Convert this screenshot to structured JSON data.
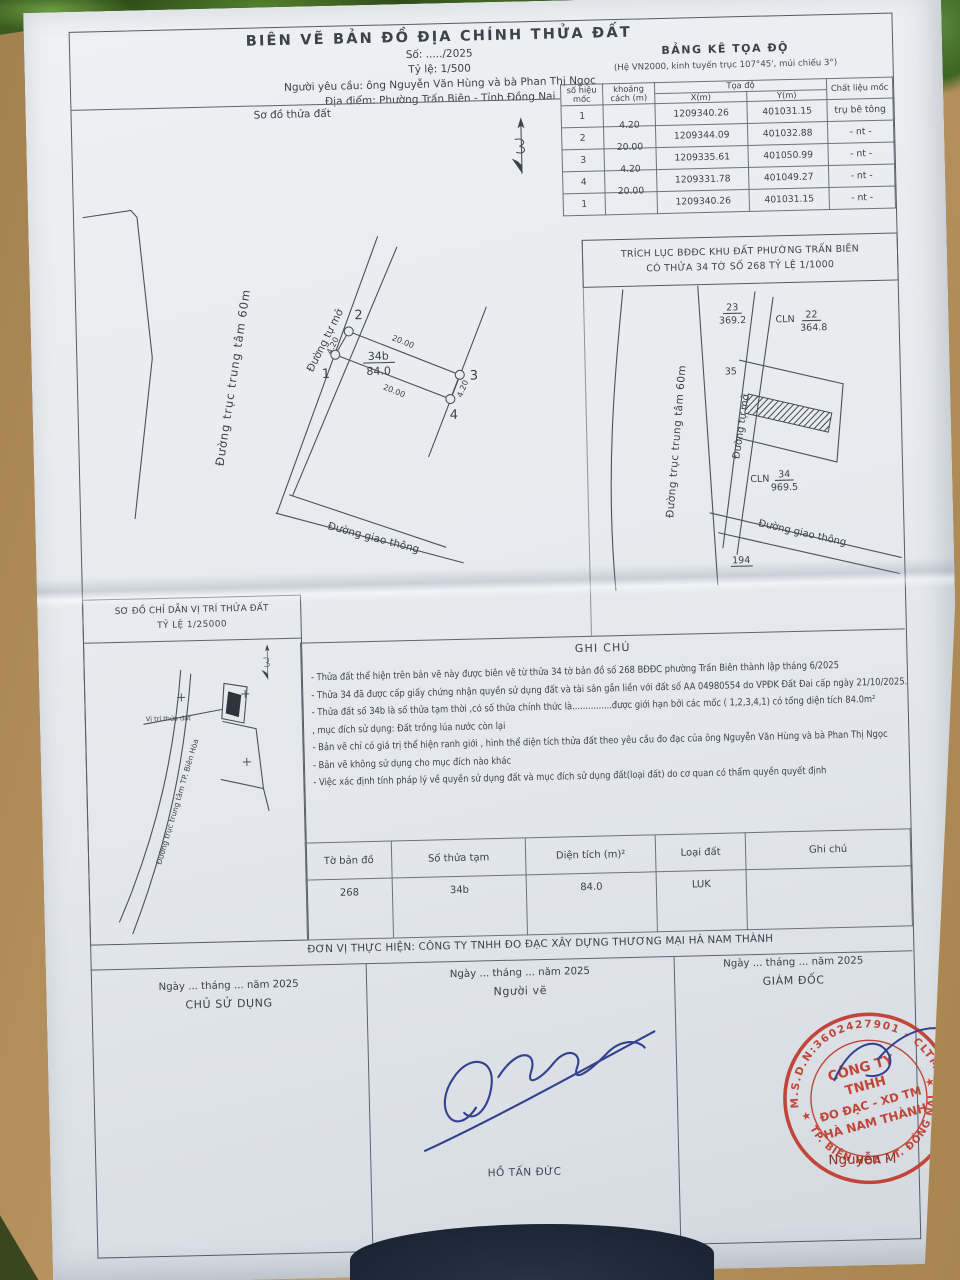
{
  "background": {
    "floor": "#b6925f",
    "foliage": "#3f6323",
    "dark_object": "#1f2838"
  },
  "doc": {
    "header": {
      "title": "BIÊN VẼ BẢN ĐỒ ĐỊA CHÍNH THỬA ĐẤT",
      "so": "Số: ...../2025",
      "scale": "Tỷ lệ: 1/500",
      "requester": "Người yêu cầu: ông Nguyễn Văn Hùng và bà Phan Thị Ngọc",
      "location": "Địa điểm: Phường Trấn Biên - Tỉnh Đồng Nai"
    },
    "coord_table": {
      "title": "BẢNG KÊ TỌA ĐỘ",
      "subtitle": "(Hệ VN2000, kinh tuyến trục 107°45', múi chiếu 3°)",
      "col_point": "số hiệu mốc",
      "col_distance": "khoảng cách (m)",
      "col_coords": "Tọa độ",
      "col_x": "X(m)",
      "col_y": "Y(m)",
      "col_material": "Chất liệu mốc",
      "rows": [
        {
          "point": "1",
          "distance": "4.20",
          "x": "1209340.26",
          "y": "401031.15",
          "material": "trụ bê tông"
        },
        {
          "point": "2",
          "distance": "20.00",
          "x": "1209344.09",
          "y": "401032.88",
          "material": "- nt -"
        },
        {
          "point": "3",
          "distance": "4.20",
          "x": "1209335.61",
          "y": "401050.99",
          "material": "- nt -"
        },
        {
          "point": "4",
          "distance": "20.00",
          "x": "1209331.78",
          "y": "401049.27",
          "material": "- nt -"
        },
        {
          "point": "1",
          "distance": "",
          "x": "1209340.26",
          "y": "401031.15",
          "material": "- nt -"
        }
      ]
    },
    "plot_sketch": {
      "label": "Sơ đồ thửa đất",
      "road_axis": "Đường trục trung tâm 60m",
      "road_open": "Đường tự mở",
      "road_traffic": "Đường giao thông",
      "parcel_id": "34b",
      "parcel_area": "84.0",
      "dim_left": "4.20",
      "dim_top": "20.00",
      "dim_bottom": "20.00",
      "dim_right": "4.20",
      "points": [
        "1",
        "2",
        "3",
        "4"
      ]
    },
    "extract": {
      "title1": "TRÍCH LỤC BĐĐC KHU ĐẤT PHƯỜNG TRẤN BIÊN",
      "title2": "CÓ THỬA 34 TỜ SỐ 268 TỶ LỆ 1/1000",
      "road_axis": "Đường trục trung tâm 60m",
      "road_open": "Đường tự mở",
      "road_traffic": "Đường giao thông",
      "p23": "23",
      "p23_area": "369.2",
      "p22_type": "CLN",
      "p22": "22",
      "p22_area": "364.8",
      "p34_type": "CLN",
      "p34": "34",
      "p34_area": "969.5",
      "n35": "35",
      "n194": "194"
    },
    "location": {
      "title": "SƠ ĐỒ CHỈ DẪN VỊ TRÍ THỬA ĐẤT",
      "scale": "TỶ LỆ 1/25000",
      "marker": "Vị trí thửa đất",
      "road": "Đường trục trung tâm TP. Biên Hòa"
    },
    "notes": {
      "title": "GHI CHÚ",
      "items": [
        "- Thửa đất thể hiện trên bản vẽ này được biên vẽ từ thửa 34 tờ bản đồ số 268 BĐĐC phường Trấn Biên thành lập tháng 6/2025",
        "- Thửa 34 đã được cấp giấy chứng nhận quyền sử dụng đất và tài sản gắn liền với đất số AA 04980554 do VPĐK Đất Đai cấp ngày 21/10/2025.",
        "- Thửa đất số 34b là số thửa tạm thời ,có số thửa chính thức là...............được giới hạn bởi các mốc ( 1,2,3,4,1) có tổng diện tích 84.0m²",
        ", mục đích sử dụng: Đất trồng lúa nước còn lại",
        "- Bản vẽ chỉ có giá trị thể hiện ranh giới , hình thể diện tích thửa đất theo yêu cầu đo đạc của ông Nguyễn Văn Hùng và bà Phan Thị Ngọc",
        "- Bản vẽ không sử dụng cho mục đích nào khác",
        "- Việc xác định tính pháp lý về quyền sử dụng đất và mục đích sử dụng đất(loại đất) do cơ quan có thẩm quyền quyết định"
      ]
    },
    "summary": {
      "headers": [
        "Tờ bản đồ",
        "Số thửa tạm",
        "Diện tích (m)²",
        "Loại đất",
        "Ghi chú"
      ],
      "values": [
        "268",
        "34b",
        "84.0",
        "LUK",
        ""
      ]
    },
    "executor": "ĐƠN VỊ THỰC HIỆN: CÔNG TY TNHH ĐO ĐẠC XÂY DỰNG THƯƠNG MẠI HÀ NAM THÀNH",
    "sign": {
      "date": "Ngày ... tháng ... năm 2025",
      "role1": "CHỦ SỬ DỤNG",
      "role2": "Người vẽ",
      "name2": "HỒ TẤN ĐỨC",
      "role3": "GIÁM ĐỐC",
      "name3": "Nguyễn M"
    },
    "stamp": {
      "ring_top": "M.S.D.N:3602427901 - CLTM",
      "ring_bottom": "TP. BIÊN HÒA - T. ĐỒNG NAI",
      "l1": "CÔNG TY",
      "l2": "TNHH",
      "l3": "ĐO ĐẠC - XD TM",
      "l4": "HÀ NAM THÀNH",
      "star": "★",
      "color": "#bf3a2b"
    }
  }
}
